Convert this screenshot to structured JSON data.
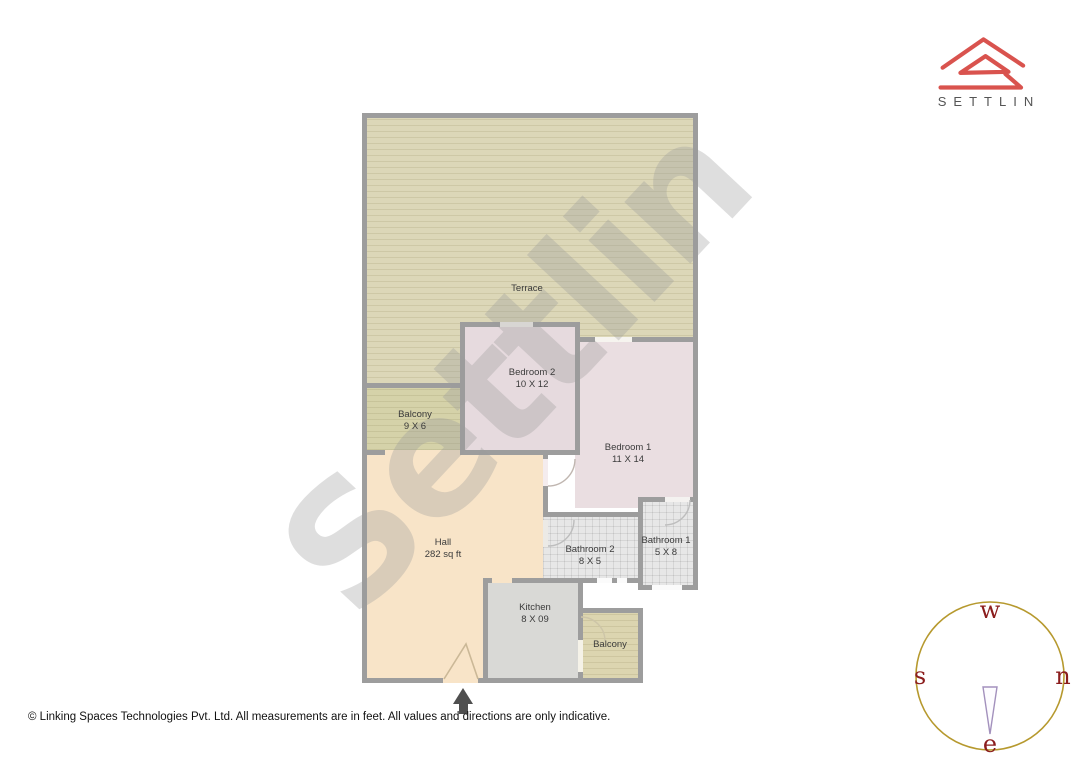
{
  "brand": {
    "wordmark": "SETTLIN",
    "logo_color": "#d9534e",
    "wordmark_color": "#555555"
  },
  "watermark": {
    "text": "Settlin"
  },
  "rooms": [
    {
      "id": "terrace",
      "name": "Terrace",
      "dims": ""
    },
    {
      "id": "bedroom2",
      "name": "Bedroom 2",
      "dims": "10 X 12"
    },
    {
      "id": "balcony-upper",
      "name": "Balcony",
      "dims": "9 X 6"
    },
    {
      "id": "bedroom1",
      "name": "Bedroom 1",
      "dims": "11 X 14"
    },
    {
      "id": "hall",
      "name": "Hall",
      "dims": "282 sq ft"
    },
    {
      "id": "bathroom2",
      "name": "Bathroom 2",
      "dims": "8 X 5"
    },
    {
      "id": "bathroom1",
      "name": "Bathroom 1",
      "dims": "5 X 8"
    },
    {
      "id": "kitchen",
      "name": "Kitchen",
      "dims": "8 X 09"
    },
    {
      "id": "balcony-lower",
      "name": "Balcony",
      "dims": ""
    }
  ],
  "compass": {
    "top": "w",
    "left": "s",
    "right": "n",
    "bottom": "e",
    "ring_color": "#b6992e",
    "letter_color": "#8b1d1d"
  },
  "entrance_marker": "entrance-arrow",
  "footer": {
    "text": "© Linking Spaces Technologies Pvt. Ltd. All measurements are in feet. All values and directions are only indicative."
  }
}
